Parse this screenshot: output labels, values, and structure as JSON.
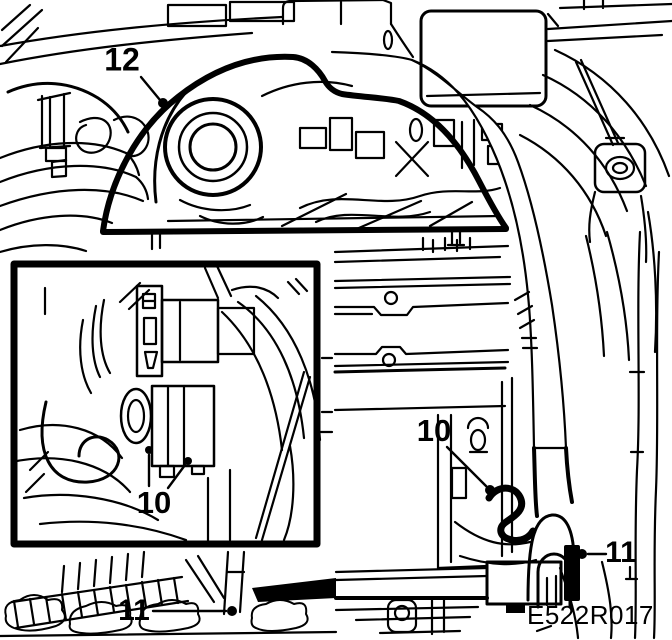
{
  "figure": {
    "background_color": "#ffffff",
    "line_color": "#000000",
    "figure_code": "E522R017",
    "callouts": {
      "air_cleaner_assembly": "12",
      "inset_valve_fasteners": "10",
      "bracket_fastener": "10",
      "lower_left_clamp": "11",
      "intake_duct_clamp": "11"
    }
  }
}
